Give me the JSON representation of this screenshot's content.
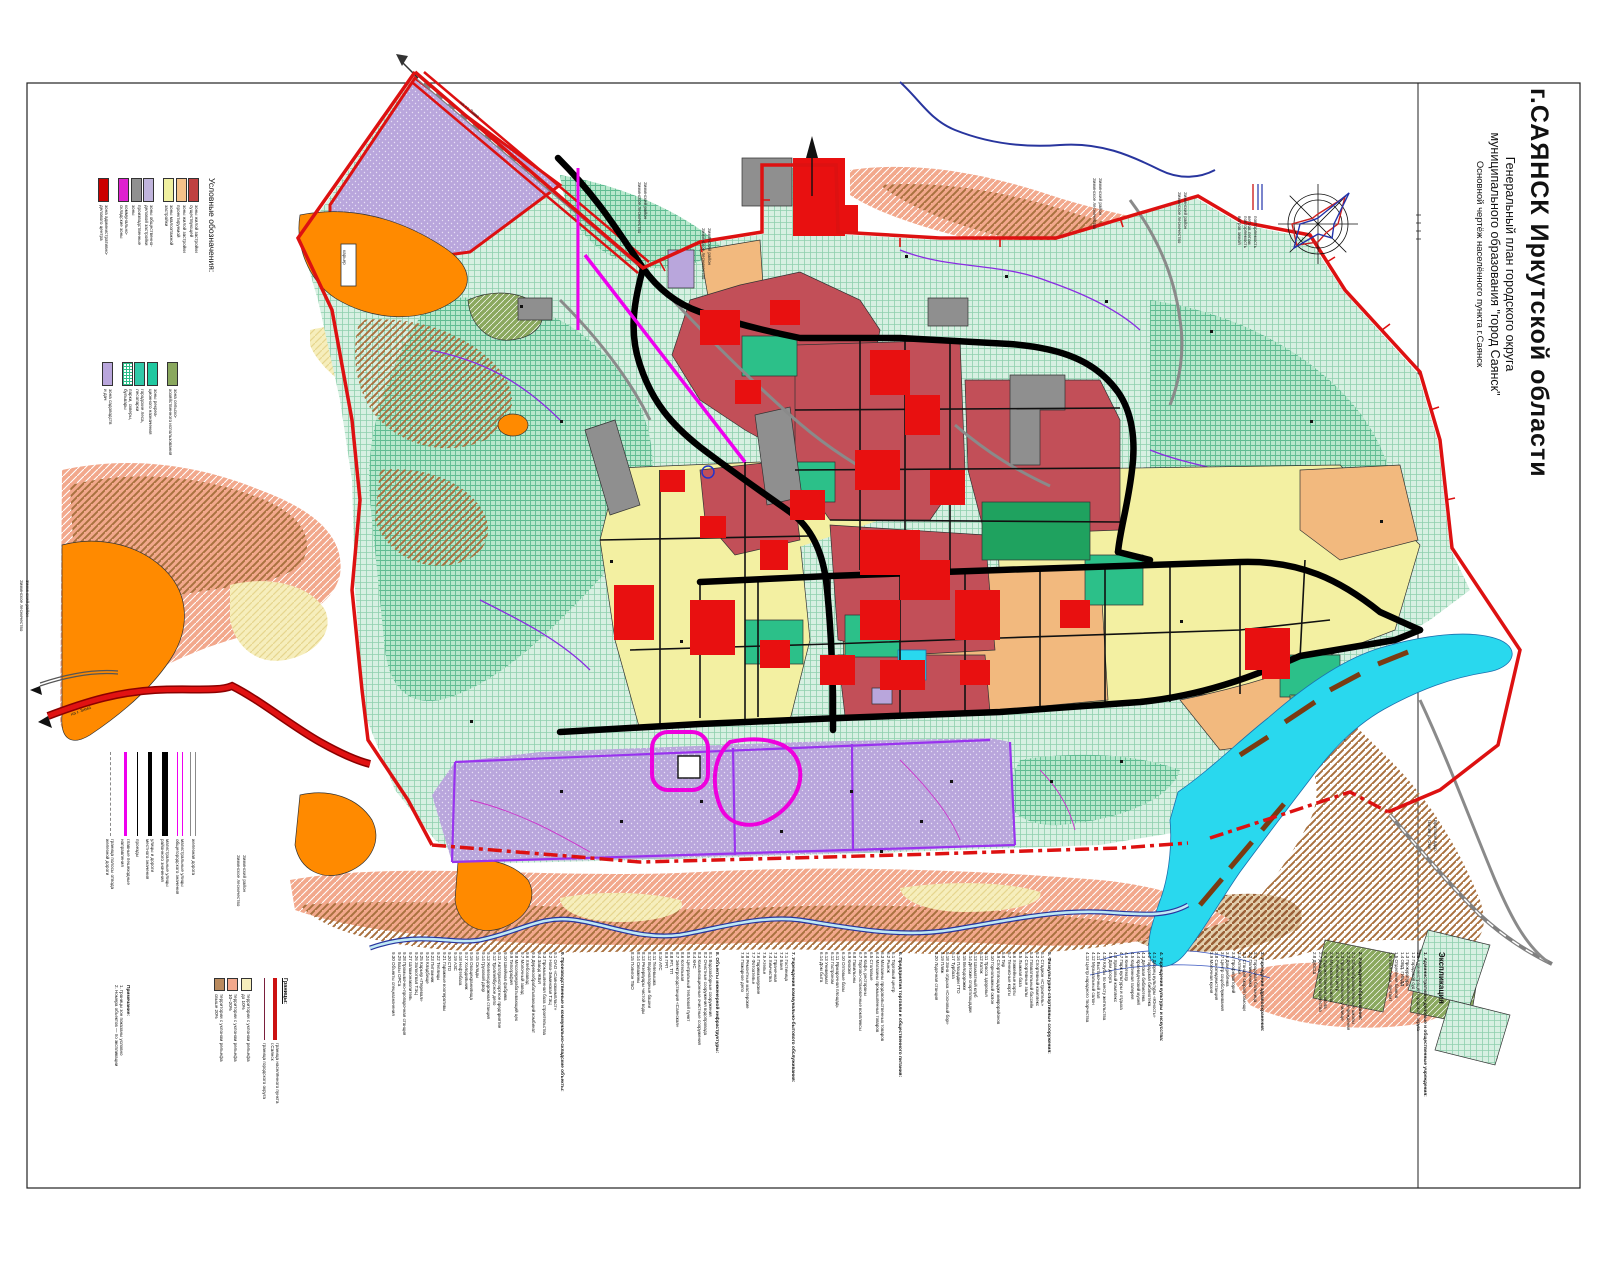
{
  "title_block": {
    "main": "г.САЯНСК Иркутской области",
    "sub1": "Генеральный план городского округа",
    "sub2": "муниципального образования \"город Саянск\"",
    "sub3": "Основной чертёж населённого пункта г.Саянск"
  },
  "colors": {
    "boundary_red": "#dd1111",
    "mint_forest": "#d7f0e2",
    "mint_dense": "#b7e7cc",
    "brick_residential": "#c24f58",
    "bright_red_objects": "#e81010",
    "tan_zone": "#f2b97e",
    "pale_yellow_zone": "#f3f0a2",
    "violet_gardens": "#b9a6dc",
    "orange_zone": "#ff8a00",
    "teal_recreation": "#2cc089",
    "olive_agric": "#8aa85e",
    "cyan_water": "#29d8ee",
    "magenta_line": "#ee00ee",
    "gray_road": "#8a8a8a"
  },
  "legend": {
    "header": "Условные обозначения:",
    "group1": [
      {
        "color": "#c04040",
        "label": "зоны жилой застройки\nсуществующей"
      },
      {
        "color": "#f5c28a",
        "label": "зоны жилой застройки\nпроектируемой"
      },
      {
        "color": "#f0f0a0",
        "label": "зоны малоэтажной\nзастройки"
      },
      {
        "color": "#c0b4dc",
        "label": "зоны общественно-\nделовой застройки",
        "gap": true
      },
      {
        "color": "#909090",
        "label": "производственные\nзоны"
      },
      {
        "color": "#e020d0",
        "label": "коммунально-\nскладские зоны"
      },
      {
        "color": "#cc0000",
        "label": "зона административно-\nделового центра",
        "gap": true
      }
    ],
    "group2": [
      {
        "color": "#8aa85e",
        "label": "зона сельско-\nхозяйственного использования"
      },
      {
        "color": "#20c8a0",
        "label": "зоны рекреа-\nционного назначения",
        "gap": true
      },
      {
        "color": "#30c8a8",
        "label": "городские леса,\nлесопарки"
      },
      {
        "color": "#ffffff",
        "hatch": true,
        "label": "парки, скверы,\nбульвары"
      },
      {
        "color": "#b9a6dc",
        "label": "зона садоводств\nи дач",
        "gap": true
      }
    ]
  },
  "line_legend": [
    {
      "style": "gray-double",
      "label": "железная дорога"
    },
    {
      "style": "magenta-double",
      "label": "магистральные улицы\nобщегородского значения"
    },
    {
      "style": "black-thick",
      "label": "магистральные улицы\nрайонного значения"
    },
    {
      "style": "black-med",
      "label": "улицы и дороги\nместного значения"
    },
    {
      "style": "black-thin",
      "label": "проезды"
    },
    {
      "style": "magenta",
      "label": "главные пешеходные\nнаправления"
    },
    {
      "style": "gray-dash",
      "label": "граница полосы отвода\nжелезной дороги"
    }
  ],
  "borders_legend": {
    "header": "Границы:",
    "items": [
      {
        "type": "line",
        "color": "#cc1111",
        "thick": true,
        "label": "граница населённого пункта г.Саянск"
      },
      {
        "type": "line",
        "color": "#7a1f3d",
        "thick": false,
        "label": "граница городского округа"
      },
      {
        "type": "swatch",
        "color": "#f6eebc",
        "gap": true,
        "label": "территории с уклоном рельефа до 10%"
      },
      {
        "type": "swatch",
        "color": "#f2a88c",
        "label": "территории с уклоном рельефа 10–20%"
      },
      {
        "type": "swatch",
        "color": "#b98a5e",
        "label": "территории с уклоном рельефа свыше 20%"
      }
    ]
  },
  "wind_rose": {
    "legend_winter": "повторяемость\nветров зимой",
    "legend_summer": "повторяемость\nветров летом"
  },
  "explication": {
    "title": "Экспликация",
    "groups": [
      {
        "x": 1428,
        "h": 16,
        "header": "",
        "items": []
      },
      {
        "x": 1383,
        "h": 44,
        "header": "1. Административно-деловые и общественные учреждения:",
        "items": [
          "1.1 Администрация городского округа",
          "1.2 Городской суд",
          "1.3 Прокуратура",
          "1.4 ОВД, ГИБДД",
          "1.5 Отделения банков",
          "1.6 Узел связи, почтамт"
        ]
      },
      {
        "x": 1302,
        "h": 60,
        "header": "2. Учреждения образования:",
        "items": [
          "2.1 Общеобразовательные школы",
          "2.2 Детские дошкольные учреждения",
          "2.3 Профессиональное училище",
          "2.4 Учебный центр",
          "2.5 Музыкальная школа",
          "2.6 Художественная школа",
          "2.7 Дом детского творчества",
          "2.8 ДЮСШ"
        ]
      },
      {
        "x": 1202,
        "h": 62,
        "header": "3. Учреждения здравоохранения:",
        "items": [
          "3.1 Городская больница",
          "3.2 Поликлиника",
          "3.3 Станция скорой помощи",
          "3.4 Аптеки",
          "3.5 Профилакторий",
          "3.6 Дом ребёнка",
          "3.7 Центр соцобслуживания",
          "3.8 Санэпидемстанция",
          "3.9 Молочная кухня"
        ]
      },
      {
        "x": 1075,
        "h": 88,
        "header": "4. Учреждения культуры и искусства:",
        "items": [
          "4.1 Дворец культуры «Юность»",
          "4.2 Городская библиотека",
          "4.3 Детская библиотека",
          "4.4 Краеведческий музей",
          "4.5 Картинная галерея",
          "4.6 Кинотеатр",
          "4.7 Парк культуры и отдыха",
          "4.8 Храмовый комплекс",
          "4.9 Дом досуга",
          "4.10 Клубы по месту жительства",
          "4.11 Выставочный зал",
          "4.12 Музыкальный салон",
          "4.13 Центр народного творчества"
        ]
      },
      {
        "x": 925,
        "h": 126,
        "header": "5. Физкультурно-спортивные сооружения:",
        "items": [
          "5.1 Стадион «Строитель»",
          "5.2 Спортивный комплекс",
          "5.3 Плавательный бассейн",
          "5.4 Спортивные залы",
          "5.5 Лыжная база",
          "5.6 Хоккейные корты",
          "5.7 Теннисные корты",
          "5.8 Тир",
          "5.9 Спортплощадки микрорайонов",
          "5.10 Горнолыжный склон",
          "5.11 Трасса здоровья",
          "5.12 Каток",
          "5.13 Шахматный клуб",
          "5.14 Детские спортплощадки",
          "5.15 Велодорожки",
          "5.16 Площадки ГТО",
          "5.17 Турбаза",
          "5.18 Зона отдыха «Сосновый бор»",
          "5.19 Пляж",
          "5.20 Лодочная станция"
        ]
      },
      {
        "x": 812,
        "h": 90,
        "header": "6. Предприятия торговли и общественного питания:",
        "items": [
          "6.1 Торговый центр",
          "6.2 Рынок",
          "6.3 Магазины продовольственных товаров",
          "6.4 Магазины промышленных товаров",
          "6.5 Столовые",
          "6.6 Кафе, рестораны",
          "6.7 Торгово-остановочные комплексы",
          "6.8 Павильоны",
          "6.9 Киоски",
          "6.10 Оптовые базы",
          "6.11 Ярмарочная площадь",
          "6.12 Гастроном",
          "6.13 Универмаг",
          "6.14 Дом быта"
        ]
      },
      {
        "x": 735,
        "h": 60,
        "header": "7. Учреждения коммунально-бытового обслуживания:",
        "items": [
          "7.1 Гостиница",
          "7.2 Баня",
          "7.3 Прачечная",
          "7.4 Химчистка",
          "7.5 Ателье",
          "7.6 Парикмахерские",
          "7.7 Фотоателье",
          "7.8 Ремонтные мастерские",
          "7.9 Пожарное депо"
        ]
      },
      {
        "x": 625,
        "h": 94,
        "header": "8. Объекты инженерной инфраструктуры:",
        "items": [
          "8.1 Водозаборные сооружения",
          "8.2 Очистные сооружения водопровода",
          "8.3 Канализационные очистные сооружения",
          "8.4 КНС",
          "8.5 Центральный тепловой пункт",
          "8.6 Котельная",
          "8.7 Электроподстанция «Саянская»",
          "8.8 РП, ТП",
          "8.9 ГРП",
          "8.10 АТС",
          "8.11 Телевышка",
          "8.12 Водонапорные башни",
          "8.13 Резервуары чистой воды",
          "8.14 Скважины",
          "8.15 Полигон ТБО"
        ]
      },
      {
        "x": 356,
        "h": 208,
        "header": "9. Производственные и коммунально-складские объекты:",
        "items": [
          "9.1 ОАО «Саянскхимпласт»",
          "9.2 Ново-Зиминская ТЭЦ",
          "9.3 Промышленная база строительства",
          "9.4 Завод ЖБИ",
          "9.5 Деревообрабатывающий комбинат",
          "9.6 Хлебозавод",
          "9.7 Молочный завод",
          "9.8 Мясоперерабатывающий цех",
          "9.9 Типография",
          "9.10 Швейная фабрика",
          "9.11 Автотранспортное предприятие",
          "9.12 Троллейбусное депо",
          "9.13 Железнодорожная станция",
          "9.14 Грузовой двор",
          "9.15 Склады",
          "9.16 Овощехранилища",
          "9.17 Холодильник",
          "9.18 Нефтебаза",
          "9.19 АЗС",
          "9.20 СТО",
          "9.21 Гаражные кооперативы",
          "9.22 Теплицы",
          "9.23 Питомник",
          "9.24 Кладбище",
          "9.25 Карьер «Перевал»",
          "9.26 Золоотвал ТЭЦ",
          "9.27 Шламонакопитель",
          "9.28 Промывочно-пропарочная станция",
          "9.29 Базы ОРСа",
          "9.30 Объекты спецназначения"
        ]
      },
      {
        "x": 86,
        "h": 44,
        "top": 985,
        "header": "Примечание:",
        "items": [
          "1. Границы зон показаны условно",
          "2. Номера объектов — по экспликации"
        ]
      }
    ]
  },
  "map_labels": [
    {
      "text": "Зиминский район\nЗиминское лесничество",
      "x": 648,
      "y": 182,
      "angle": 90
    },
    {
      "text": "Зиминский район\nЗиминское лесничество",
      "x": 712,
      "y": 228,
      "angle": 90
    },
    {
      "text": "Зиминский район\nЗиминское лесничество",
      "x": 1103,
      "y": 178,
      "angle": 90
    },
    {
      "text": "Зиминский район\nЗиминское лесничество",
      "x": 1188,
      "y": 192,
      "angle": 90
    },
    {
      "text": "Зиминский район\nЗиминское лесничество",
      "x": 30,
      "y": 580,
      "angle": 90
    },
    {
      "text": "Зиминский район\nЗиминское лесничество",
      "x": 247,
      "y": 855,
      "angle": 90
    },
    {
      "text": "Братское вдхр.\n/залив р. Ока/",
      "x": 1438,
      "y": 820,
      "angle": 90
    },
    {
      "text": "на ст. Зима",
      "x": 462,
      "y": 100,
      "angle": 40
    },
    {
      "text": "на г. Зима",
      "x": 70,
      "y": 712,
      "angle": -20
    },
    {
      "text": "карьер",
      "x": 347,
      "y": 250,
      "angle": 90
    },
    {
      "text": "повторяемость\nветров зимой",
      "x": 1248,
      "y": 216,
      "angle": 90
    },
    {
      "text": "повторяемость\nветров летом",
      "x": 1258,
      "y": 216,
      "angle": 90
    }
  ]
}
